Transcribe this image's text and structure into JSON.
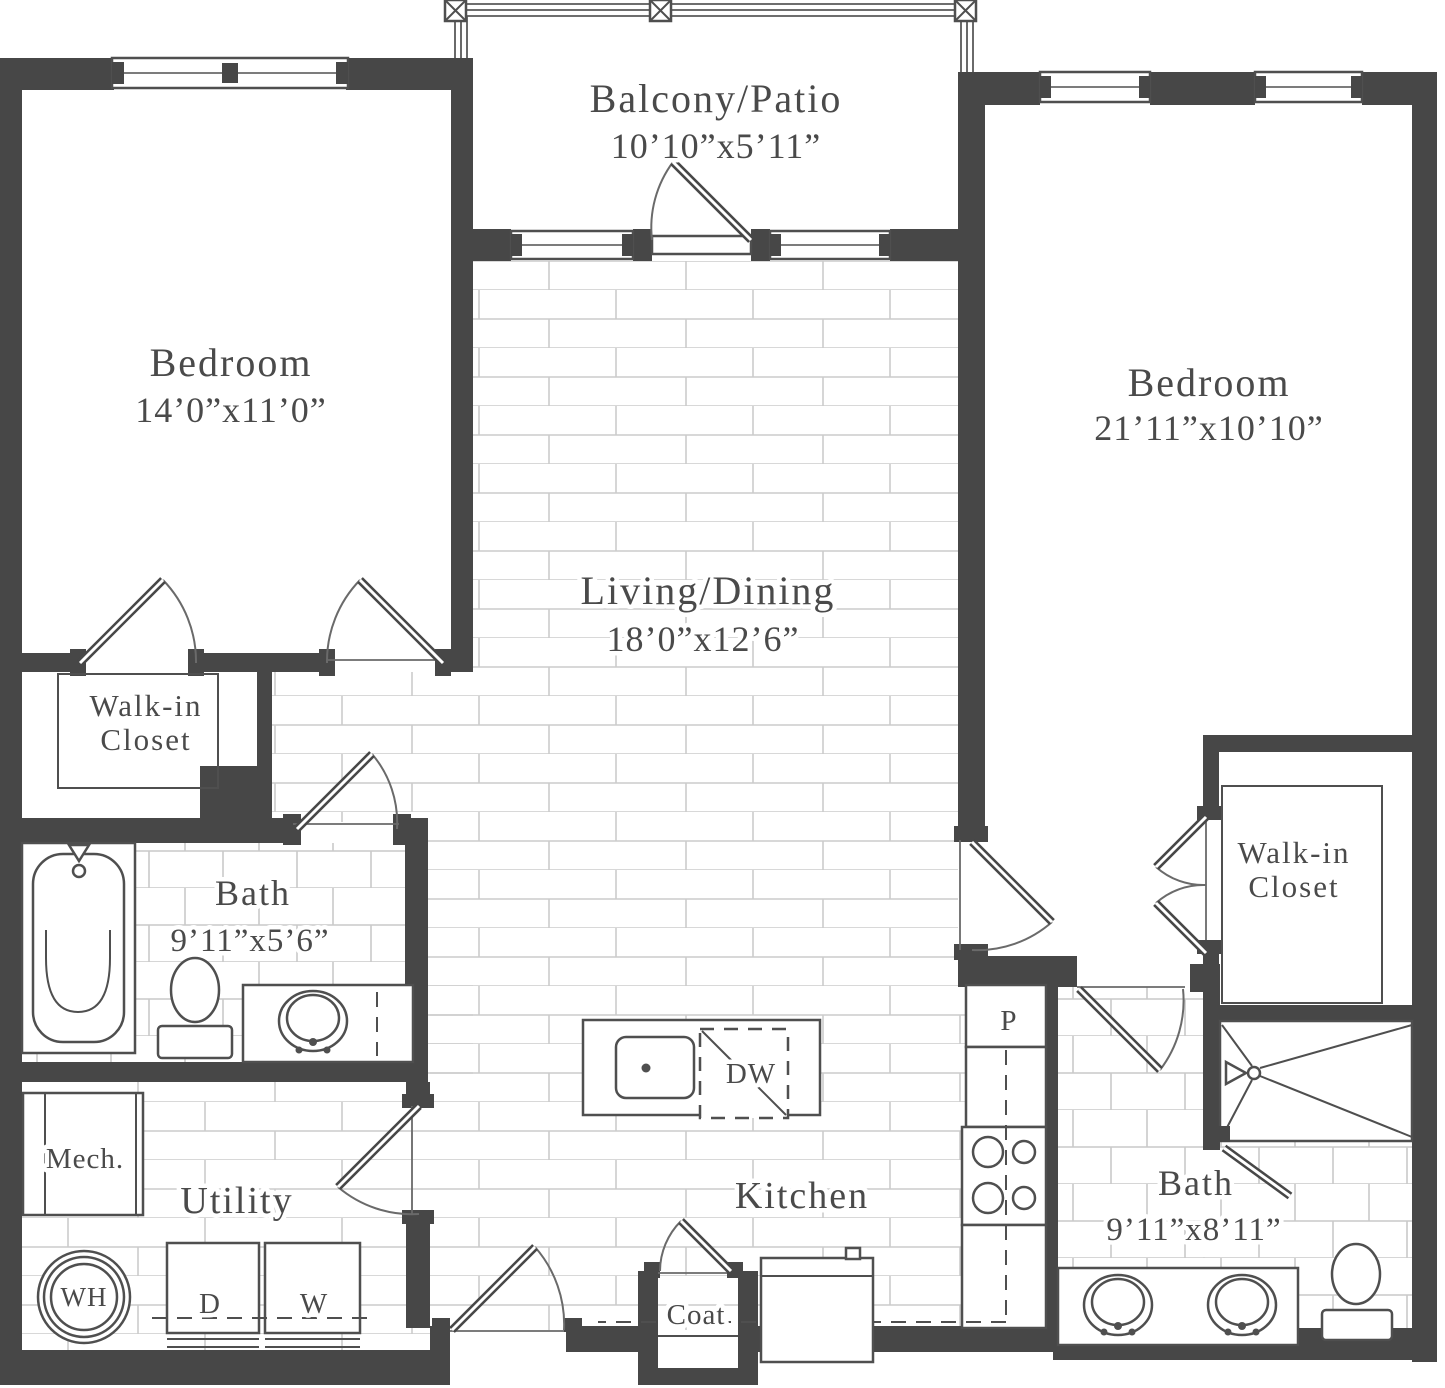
{
  "rooms": {
    "balcony": {
      "name": "Balcony/Patio",
      "dims": "10’10”x5’11”"
    },
    "bedroom1": {
      "name": "Bedroom",
      "dims": "14’0”x11’0”"
    },
    "bedroom2": {
      "name": "Bedroom",
      "dims": "21’11”x10’10”"
    },
    "living": {
      "name": "Living/Dining",
      "dims": "18’0”x12’6”"
    },
    "bath1": {
      "name": "Bath",
      "dims": "9’11”x5’6”"
    },
    "bath2": {
      "name": "Bath",
      "dims": "9’11”x8’11”"
    },
    "walkin_closet_1": {
      "line1": "Walk-in",
      "line2": "Closet"
    },
    "walkin_closet_2": {
      "line1": "Walk-in",
      "line2": "Closet"
    },
    "utility": {
      "name": "Utility"
    },
    "kitchen": {
      "name": "Kitchen"
    },
    "coat": {
      "name": "Coat"
    },
    "mech": {
      "name": "Mech."
    }
  },
  "labels": {
    "water_heater": "WH",
    "dryer": "D",
    "washer": "W",
    "dishwasher": "DW",
    "pantry": "P"
  },
  "colors": {
    "wall": "#474747",
    "line": "#4f4f4f",
    "text": "#4a4a4a",
    "plank_line": "#cccccc",
    "tile_line": "#c9c9c9",
    "background": "#ffffff"
  }
}
